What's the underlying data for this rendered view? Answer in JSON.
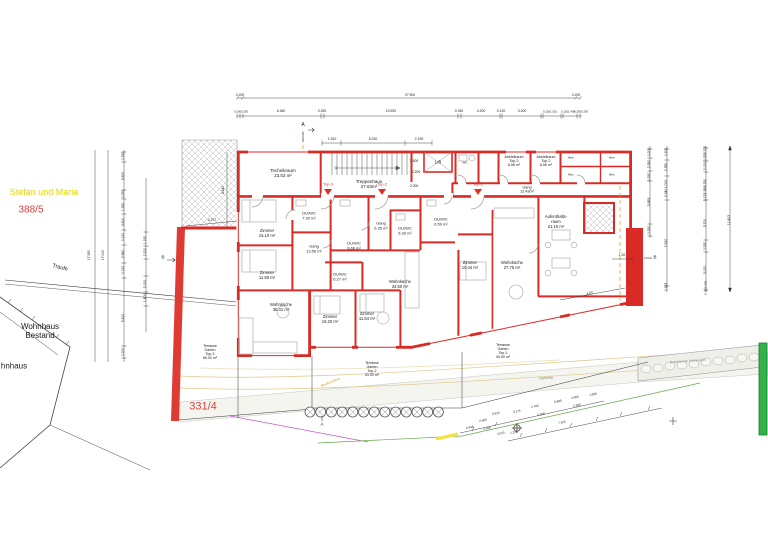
{
  "colors": {
    "wall_red": "#d92b26",
    "parcel_red": "#e03c3c",
    "owner_yellow": "#e6d50a",
    "green_marker": "#35b14b",
    "section_orange": "#e8a030",
    "contour_tan": "#ddc98f",
    "magenta_line": "#c959c9",
    "green_line": "#6aa84f"
  },
  "labels": [
    {
      "n": "room-technikraum",
      "t": "Technikraum\n23.53 m²",
      "x": 283,
      "y": 173,
      "s": 4.5
    },
    {
      "n": "room-treppenhaus",
      "t": "Treppenhaus\n27.63m²",
      "x": 369,
      "y": 184,
      "s": 4.5
    },
    {
      "n": "room-lift",
      "t": "Lift",
      "x": 438,
      "y": 162,
      "s": 4.5
    },
    {
      "n": "room-wc",
      "t": "WC",
      "x": 465,
      "y": 163,
      "s": 3
    },
    {
      "n": "room-abstellraum-top3",
      "t": "Abstellraum\nTop-3\n6.56 m²",
      "x": 514,
      "y": 161,
      "s": 3.6
    },
    {
      "n": "room-abstellraum-top2",
      "t": "Abstellraum\nTop-2\n6.56 m²",
      "x": 546,
      "y": 161,
      "s": 3.6
    },
    {
      "n": "room-abst-1",
      "t": "Abst.",
      "x": 571,
      "y": 158,
      "s": 2.8
    },
    {
      "n": "room-abst-2",
      "t": "Abst.",
      "x": 612,
      "y": 158,
      "s": 2.8
    },
    {
      "n": "room-abst-3",
      "t": "Abst.",
      "x": 571,
      "y": 175,
      "s": 2.8
    },
    {
      "n": "room-abst-4",
      "t": "Abst.",
      "x": 612,
      "y": 175,
      "s": 2.8
    },
    {
      "n": "room-gang-og",
      "t": "Gang\n12.43m²",
      "x": 527,
      "y": 190,
      "s": 3.8
    },
    {
      "n": "room-zimmer-1510",
      "t": "Zimmer\n15.10 m²",
      "x": 267,
      "y": 234,
      "s": 4.2
    },
    {
      "n": "room-duwc-730",
      "t": "DU/WC\n7.30 m²",
      "x": 309,
      "y": 216,
      "s": 4
    },
    {
      "n": "room-gang-1356",
      "t": "Gang\n13.56 m²",
      "x": 314,
      "y": 249,
      "s": 4
    },
    {
      "n": "room-zimmer-1190",
      "t": "Zimmer\n11.90 m²",
      "x": 267,
      "y": 276,
      "s": 4.2
    },
    {
      "n": "room-wohnkueche-3041",
      "t": "Wohnküche\n30.41 m²",
      "x": 281,
      "y": 308,
      "s": 4.2
    },
    {
      "n": "room-duwc-966",
      "t": "DU/WC\n9.66 m²",
      "x": 354,
      "y": 246,
      "s": 4
    },
    {
      "n": "room-gang-635",
      "t": "Gang\n6.35 m²",
      "x": 381,
      "y": 226,
      "s": 4
    },
    {
      "n": "room-duwc-633",
      "t": "DU/WC\n6.33 m²",
      "x": 405,
      "y": 231,
      "s": 4
    },
    {
      "n": "room-duwc-627",
      "t": "DU/WC\n6.27 m²",
      "x": 340,
      "y": 277,
      "s": 4
    },
    {
      "n": "room-wohnkueche-3450",
      "t": "Wohnküche\n34.50 m²",
      "x": 400,
      "y": 285,
      "s": 4.2
    },
    {
      "n": "room-zimmer-1520",
      "t": "Zimmer\n15.20 m²",
      "x": 330,
      "y": 320,
      "s": 4.2
    },
    {
      "n": "room-zimmer-1184",
      "t": "Zimmer\n11.84 m²",
      "x": 367,
      "y": 317,
      "s": 4.2
    },
    {
      "n": "room-duwc-650",
      "t": "DU/WC\n6.50 m²",
      "x": 441,
      "y": 222,
      "s": 4
    },
    {
      "n": "room-zimmer-1044",
      "t": "Zimmer\n10.44 m²",
      "x": 470,
      "y": 266,
      "s": 4.2
    },
    {
      "n": "room-wohnkueche-2775",
      "t": "Wohnküche\n27.75 m²",
      "x": 512,
      "y": 266,
      "s": 4.2
    },
    {
      "n": "room-aufenthaltsraum",
      "t": "Aufenthalts-\nraum\n21.10 m²",
      "x": 556,
      "y": 222,
      "s": 4.2
    },
    {
      "n": "room-terrasse-top3",
      "t": "Terrasse\nGarten\nTop-3\n66.00 m²",
      "x": 210,
      "y": 352,
      "s": 3.6
    },
    {
      "n": "room-terrasse-top2",
      "t": "Terrasse\nGarten\nTop-2\n53.00 m²",
      "x": 372,
      "y": 369,
      "s": 3.6
    },
    {
      "n": "room-terrasse-top1",
      "t": "Terrasse\nGarten\nTop-1\n40.00 m²",
      "x": 503,
      "y": 351,
      "s": 3.6
    },
    {
      "n": "unit-marker-top3",
      "t": "Top-3",
      "x": 328,
      "y": 185,
      "s": 4,
      "c": "#e03028"
    },
    {
      "n": "unit-marker-top2",
      "t": "Top-2",
      "x": 382,
      "y": 185,
      "s": 4,
      "c": "#e03028"
    },
    {
      "n": "unit-marker-top1",
      "t": "Top-1",
      "x": 478,
      "y": 185,
      "s": 4,
      "c": "#e03028"
    },
    {
      "n": "owner-name",
      "t": "Stefan und Maria",
      "x": 44,
      "y": 192,
      "s": 9,
      "c": "#e6d50a"
    },
    {
      "n": "parcel-388-5",
      "t": "388/5",
      "x": 31,
      "y": 210,
      "s": 10,
      "c": "#e03c3c"
    },
    {
      "n": "parcel-331-4",
      "t": "331/4",
      "x": 203,
      "y": 407,
      "s": 11,
      "c": "#e03c3c"
    },
    {
      "n": "existing-house-label",
      "t": "Wohnhaus\nBestand",
      "x": 40,
      "y": 331,
      "s": 8
    },
    {
      "n": "existing-house-label-cut",
      "t": "hnhaus",
      "x": 14,
      "y": 366,
      "s": 8
    },
    {
      "n": "traufe-label",
      "t": "Traufe",
      "x": 60,
      "y": 268,
      "s": 5.5,
      "r": 14
    },
    {
      "n": "gehweg-label",
      "t": "Gehweg",
      "x": 546,
      "y": 378,
      "s": 3.6,
      "c": "#777777",
      "r": -5
    },
    {
      "n": "steinmauer-label",
      "t": "Bestehende Steinmauer",
      "x": 688,
      "y": 362,
      "s": 3.4,
      "c": "#888888",
      "r": -4
    },
    {
      "n": "baufluchtlinie-label",
      "t": "Baufluchtlinie",
      "x": 331,
      "y": 383,
      "s": 3.4,
      "c": "#d89a28",
      "r": -22
    },
    {
      "n": "section-a-top",
      "t": "A",
      "x": 303,
      "y": 126,
      "s": 5
    },
    {
      "n": "section-a-bottom",
      "t": "A",
      "x": 322,
      "y": 424,
      "s": 4.5
    },
    {
      "n": "section-b-left",
      "t": "B",
      "x": 163,
      "y": 257,
      "s": 4.5
    },
    {
      "n": "section-b-right",
      "t": "B",
      "x": 655,
      "y": 257,
      "s": 4.5
    },
    {
      "t": "0.200",
      "x": 240,
      "y": 96
    },
    {
      "t": "27.900",
      "x": 410,
      "y": 96
    },
    {
      "t": "0.200",
      "x": 576,
      "y": 96
    },
    {
      "t": "0.2000.250",
      "x": 241,
      "y": 112,
      "s": 2.8
    },
    {
      "t": "6.360",
      "x": 281,
      "y": 112
    },
    {
      "t": "0.250",
      "x": 322,
      "y": 112
    },
    {
      "t": "10.920",
      "x": 391,
      "y": 112
    },
    {
      "t": "0.250",
      "x": 459,
      "y": 112
    },
    {
      "t": "3.200",
      "x": 481,
      "y": 112
    },
    {
      "t": "0.120",
      "x": 501,
      "y": 112
    },
    {
      "t": "3.200",
      "x": 522,
      "y": 112
    },
    {
      "t": "0.1201.510",
      "x": 550,
      "y": 112,
      "s": 2.8
    },
    {
      "t": "0.1201.400",
      "x": 568,
      "y": 112,
      "s": 2.8
    },
    {
      "t": "0.2500.250",
      "x": 581,
      "y": 112,
      "s": 2.8
    },
    {
      "t": "1.510",
      "x": 332,
      "y": 140
    },
    {
      "t": "5.220",
      "x": 373,
      "y": 140
    },
    {
      "t": "2.190",
      "x": 419,
      "y": 140
    },
    {
      "t": "1.500",
      "x": 414,
      "y": 162
    },
    {
      "t": "0.200",
      "x": 416,
      "y": 173
    },
    {
      "t": "2.000",
      "x": 414,
      "y": 187
    },
    {
      "t": "17.350",
      "x": 90,
      "y": 255,
      "r": -90,
      "s": 3.4
    },
    {
      "t": "17.000",
      "x": 104,
      "y": 255,
      "r": -90,
      "s": 3.4
    },
    {
      "t": "0.250",
      "x": 124,
      "y": 156,
      "r": -90
    },
    {
      "t": "5.600",
      "x": 124,
      "y": 176,
      "r": -90
    },
    {
      "t": "0.250",
      "x": 124,
      "y": 194,
      "r": -90
    },
    {
      "t": "1.250",
      "x": 124,
      "y": 207,
      "r": -90
    },
    {
      "t": "3.600",
      "x": 124,
      "y": 222,
      "r": -90
    },
    {
      "t": "0.120",
      "x": 124,
      "y": 237,
      "r": -90
    },
    {
      "t": "2.960",
      "x": 124,
      "y": 254,
      "r": -90
    },
    {
      "t": "0.120",
      "x": 124,
      "y": 270,
      "r": -90
    },
    {
      "t": "5.410",
      "x": 124,
      "y": 318,
      "r": -90
    },
    {
      "t": "0.200",
      "x": 124,
      "y": 352,
      "r": -90
    },
    {
      "t": "1.150",
      "x": 146,
      "y": 240,
      "r": -90
    },
    {
      "t": "2.200",
      "x": 146,
      "y": 252,
      "r": -90
    },
    {
      "t": "2.000",
      "x": 146,
      "y": 284,
      "r": -90
    },
    {
      "t": "1.800",
      "x": 146,
      "y": 298,
      "r": -90
    },
    {
      "t": "4.440",
      "x": 224,
      "y": 190,
      "r": -90
    },
    {
      "t": "4.727",
      "x": 212,
      "y": 221
    },
    {
      "t": "0.200",
      "x": 650,
      "y": 152,
      "r": -90
    },
    {
      "t": "2.550",
      "x": 650,
      "y": 164,
      "r": -90
    },
    {
      "t": "0.250",
      "x": 650,
      "y": 177,
      "r": -90
    },
    {
      "t": "5.893",
      "x": 650,
      "y": 202,
      "r": -90
    },
    {
      "t": "0.250",
      "x": 650,
      "y": 230,
      "r": -90
    },
    {
      "t": "0.200",
      "x": 667,
      "y": 152,
      "r": -90
    },
    {
      "t": "2.780",
      "x": 667,
      "y": 167,
      "r": -90
    },
    {
      "t": "1.000",
      "x": 667,
      "y": 184,
      "r": -90
    },
    {
      "t": "2.340",
      "x": 667,
      "y": 193,
      "r": -90
    },
    {
      "t": "7.620",
      "x": 667,
      "y": 243,
      "r": -90
    },
    {
      "t": "0.163",
      "x": 667,
      "y": 287,
      "r": -90
    },
    {
      "t": "0.700",
      "x": 706,
      "y": 150,
      "r": -90
    },
    {
      "t": "0.250",
      "x": 706,
      "y": 157,
      "r": -90
    },
    {
      "t": "2.000",
      "x": 706,
      "y": 166,
      "r": -90
    },
    {
      "t": "0.250",
      "x": 706,
      "y": 183,
      "r": -90
    },
    {
      "t": "1.560",
      "x": 706,
      "y": 190,
      "r": -90
    },
    {
      "t": "0.120",
      "x": 706,
      "y": 197,
      "r": -90
    },
    {
      "t": "3.700",
      "x": 706,
      "y": 223,
      "r": -90
    },
    {
      "t": "0.250",
      "x": 706,
      "y": 246,
      "r": -90
    },
    {
      "t": "3.000",
      "x": 706,
      "y": 270,
      "r": -90
    },
    {
      "t": "0.1630.208",
      "x": 706,
      "y": 288,
      "r": -90,
      "s": 2.8
    },
    {
      "t": "11.803",
      "x": 730,
      "y": 220,
      "r": -90,
      "s": 3.4
    },
    {
      "t": "1.20",
      "x": 622,
      "y": 256
    },
    {
      "t": "4.02",
      "x": 590,
      "y": 294,
      "r": -18
    },
    {
      "t": "0.438",
      "x": 470,
      "y": 428,
      "r": -12,
      "s": 3
    },
    {
      "t": "2.500",
      "x": 483,
      "y": 421,
      "r": -12,
      "s": 3
    },
    {
      "t": "0.615",
      "x": 496,
      "y": 414,
      "r": -12,
      "s": 3
    },
    {
      "t": "2.200",
      "x": 487,
      "y": 429,
      "r": -12,
      "s": 3
    },
    {
      "t": "3.073",
      "x": 501,
      "y": 434,
      "r": -12,
      "s": 3
    },
    {
      "t": "0.275",
      "x": 517,
      "y": 412,
      "r": -12,
      "s": 3
    },
    {
      "t": "2.700",
      "x": 535,
      "y": 407,
      "r": -12,
      "s": 3
    },
    {
      "t": "2.200",
      "x": 541,
      "y": 415,
      "r": -12,
      "s": 3
    },
    {
      "t": "0.800",
      "x": 558,
      "y": 402,
      "r": -12,
      "s": 3
    },
    {
      "t": "2.000",
      "x": 575,
      "y": 398,
      "r": -12,
      "s": 3
    },
    {
      "t": "2.200",
      "x": 577,
      "y": 406,
      "r": -12,
      "s": 3
    },
    {
      "t": "1.080",
      "x": 593,
      "y": 395,
      "r": -12,
      "s": 3
    },
    {
      "t": "7.325",
      "x": 562,
      "y": 423,
      "r": -12,
      "s": 3
    },
    {
      "t": "1.225",
      "x": 514,
      "y": 433,
      "r": -12,
      "s": 3
    }
  ]
}
